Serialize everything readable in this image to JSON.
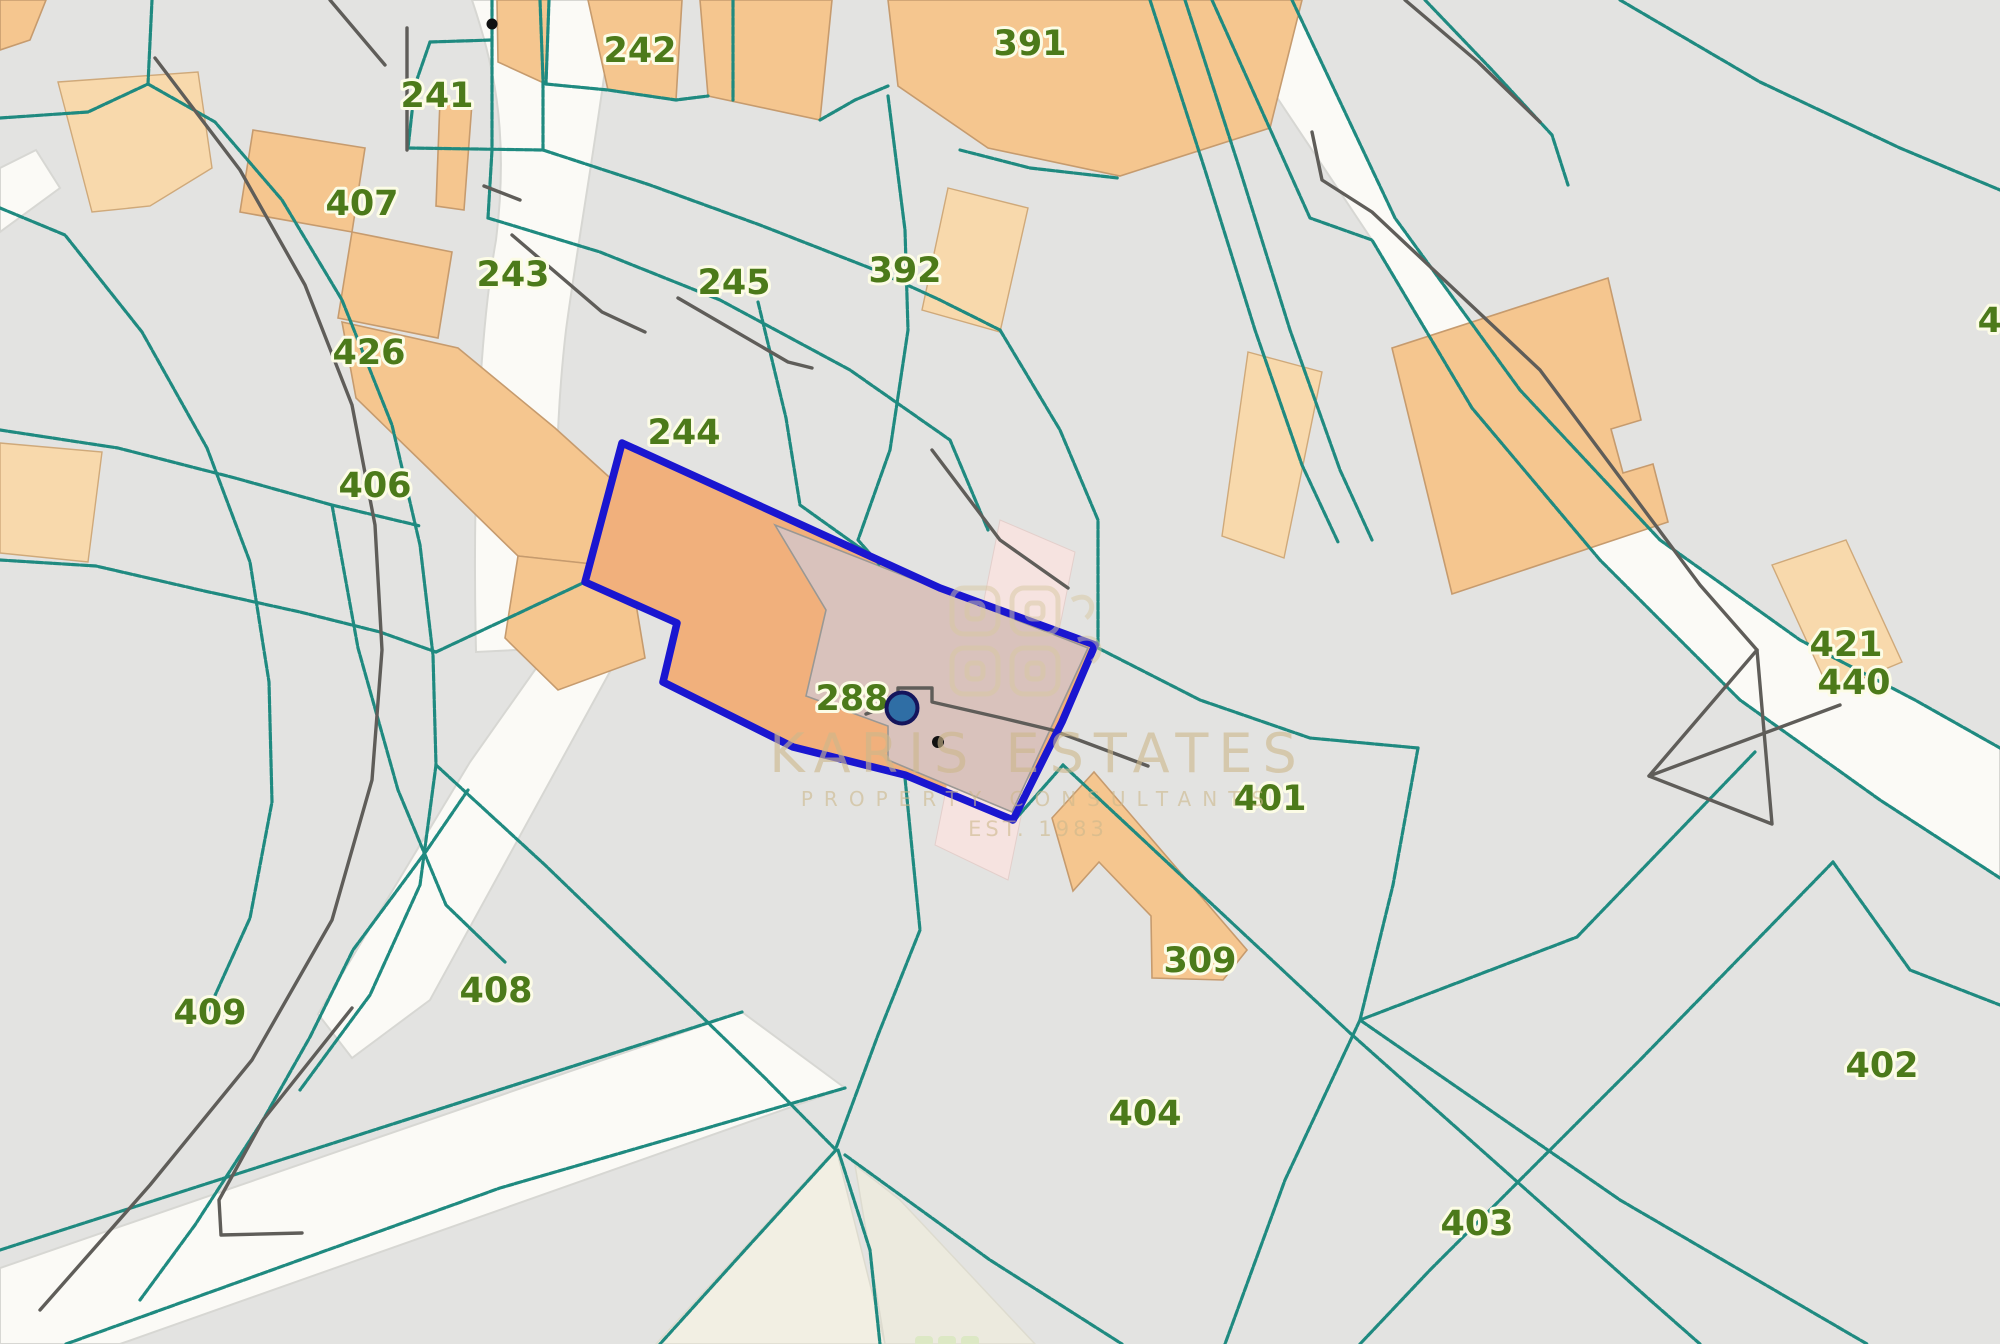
{
  "map": {
    "type": "cadastral-parcel-map",
    "highlight": {
      "parcel": "288"
    },
    "labels": [
      {
        "id": "242",
        "text": "242"
      },
      {
        "id": "241",
        "text": "241"
      },
      {
        "id": "407",
        "text": "407"
      },
      {
        "id": "243",
        "text": "243"
      },
      {
        "id": "426",
        "text": "426"
      },
      {
        "id": "245",
        "text": "245"
      },
      {
        "id": "244",
        "text": "244"
      },
      {
        "id": "392",
        "text": "392"
      },
      {
        "id": "391",
        "text": "391"
      },
      {
        "id": "406",
        "text": "406"
      },
      {
        "id": "288",
        "text": "288"
      },
      {
        "id": "421",
        "text": "421"
      },
      {
        "id": "440",
        "text": "440"
      },
      {
        "id": "401",
        "text": "401"
      },
      {
        "id": "409",
        "text": "409"
      },
      {
        "id": "408",
        "text": "408"
      },
      {
        "id": "309",
        "text": "309"
      },
      {
        "id": "404",
        "text": "404"
      },
      {
        "id": "402",
        "text": "402"
      },
      {
        "id": "403",
        "text": "403"
      },
      {
        "id": "43",
        "text": "43"
      }
    ],
    "watermark": {
      "title": "KARIS ESTATES",
      "subtitle": "PROPERTY CONSULTANTS",
      "est": "EST. 1983"
    },
    "colors": {
      "background": "#e3e3e1",
      "road": "#fbfaf6",
      "road_wedge": "#f2efe3",
      "parcel_line_teal": "#1f8a80",
      "feature_line_gray": "#5f5d59",
      "building_orange": "#f5c68f",
      "building_light": "#f8d9ac",
      "highlight_fill": "#f1b07c",
      "highlight_stroke": "#1a16d0",
      "building_overlay_pink": "#d9c2bc",
      "road_pink": "#f6e3e0",
      "label_green": "#4c7a1a",
      "marker_blue": "#2f6ea5",
      "watermark_tan": "#cdb88c"
    }
  }
}
